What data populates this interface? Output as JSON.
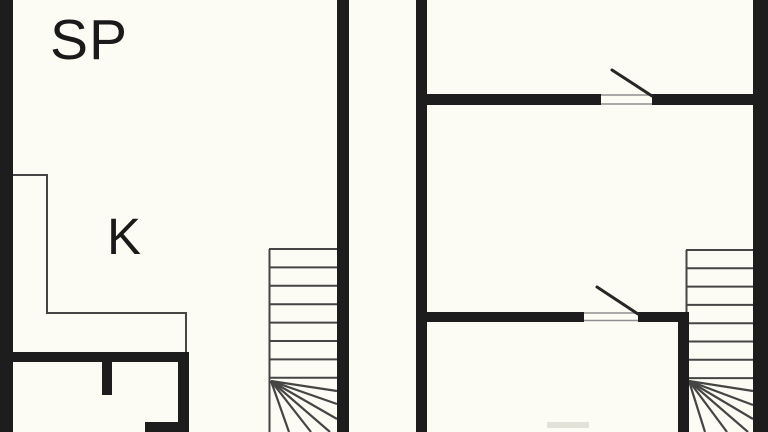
{
  "title": "floor-plan",
  "labels": {
    "sp": "SP",
    "k": "K"
  },
  "plan": {
    "background": "#fcfcf5",
    "colors": {
      "wall": "#1d1d1d",
      "thin": "#454545",
      "swing": "#262626",
      "threshold": "#8f8f8f",
      "faint": "#e2e2d9"
    },
    "kitchen_outline": "13,175 47,175 47,313 186,313 186,353",
    "stairs": [
      {
        "name": "staircase-left",
        "edge": {
          "x": 269.5,
          "y1": 249,
          "y2": 432
        },
        "treads": {
          "x1": 269,
          "x2": 337,
          "ys": [
            249,
            267.4,
            285.8,
            304.2,
            322.6,
            341,
            359.4,
            377.8
          ]
        },
        "fan": {
          "cx": 271,
          "cy": 381,
          "rays": [
            [
              337,
              391
            ],
            [
              337,
              404
            ],
            [
              337,
              419
            ],
            [
              330,
              432
            ],
            [
              311,
              432
            ],
            [
              289,
              432
            ]
          ]
        }
      },
      {
        "name": "staircase-right",
        "edge": {
          "x": 686.5,
          "y1": 250,
          "y2": 312
        },
        "treads": {
          "x1": 686,
          "x2": 753,
          "ys": [
            250,
            268.3,
            286.6,
            304.9,
            323.2,
            341.5,
            359.8,
            378.1
          ]
        },
        "fan": {
          "cx": 689,
          "cy": 381,
          "rays": [
            [
              753,
              391
            ],
            [
              753,
              405
            ],
            [
              753,
              419
            ],
            [
              748,
              432
            ],
            [
              727,
              432
            ],
            [
              705,
              432
            ]
          ]
        }
      }
    ],
    "walls": [
      {
        "x": 0,
        "y": 0,
        "w": 13,
        "h": 432
      },
      {
        "x": 337,
        "y": 0,
        "w": 12,
        "h": 432
      },
      {
        "x": 0,
        "y": 352,
        "w": 189,
        "h": 10
      },
      {
        "x": 178,
        "y": 352,
        "w": 11,
        "h": 80
      },
      {
        "x": 102,
        "y": 362,
        "w": 10,
        "h": 33
      },
      {
        "x": 145,
        "y": 422,
        "w": 44,
        "h": 10
      },
      {
        "x": 416,
        "y": 0,
        "w": 11,
        "h": 432
      },
      {
        "x": 753,
        "y": 0,
        "w": 15,
        "h": 432
      },
      {
        "x": 427,
        "y": 94,
        "w": 174,
        "h": 11
      },
      {
        "x": 652,
        "y": 94,
        "w": 116,
        "h": 11
      },
      {
        "x": 427,
        "y": 312,
        "w": 157,
        "h": 10
      },
      {
        "x": 638,
        "y": 312,
        "w": 51,
        "h": 10
      },
      {
        "x": 678,
        "y": 312,
        "w": 11,
        "h": 120
      }
    ],
    "thresholds": [
      {
        "x1": 601,
        "y1": 95,
        "x2": 652,
        "y2": 95
      },
      {
        "x1": 601,
        "y1": 104,
        "x2": 652,
        "y2": 104
      },
      {
        "x1": 584,
        "y1": 313,
        "x2": 638,
        "y2": 313
      },
      {
        "x1": 584,
        "y1": 320.5,
        "x2": 638,
        "y2": 320.5
      }
    ],
    "door_swings": [
      {
        "x1": 612,
        "y1": 70,
        "x2": 652,
        "y2": 96
      },
      {
        "x1": 597,
        "y1": 287,
        "x2": 638,
        "y2": 314
      }
    ],
    "faint_hint": {
      "x": 547,
      "y": 422,
      "w": 42,
      "h": 6
    }
  }
}
